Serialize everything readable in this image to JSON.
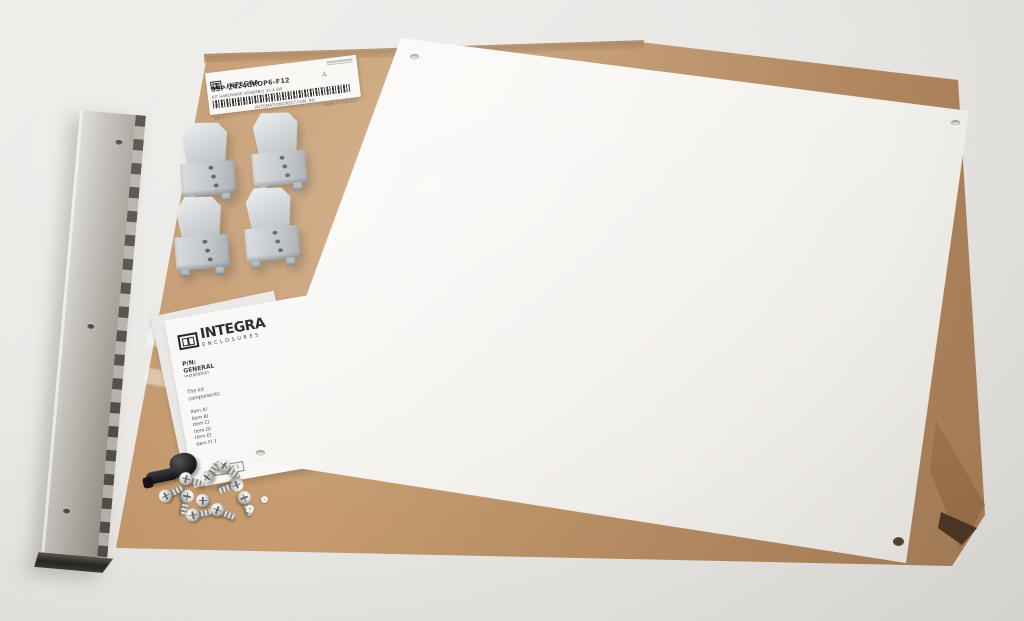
{
  "colors": {
    "background": "#e9e7e4",
    "cardboard": "#b98e63",
    "panel_white": "#f9f7f4",
    "hinge_metal": "#b0aca5",
    "clip_gray": "#c3c8cb"
  },
  "shipping_label": {
    "brand": "INTEGRA",
    "part_number": "SSP-2424GROP6-F12",
    "sub_line": "KIT HARDWARE ASSEMBLY 23-4 SW",
    "footer": "AUTOMATIONDIRECT.COM, INC",
    "lbl_note": "LBL 1",
    "origin": "MADE IN THE USA",
    "warning_glyph": "⚠"
  },
  "instruction_sheet": {
    "brand": "INTEGRA",
    "brand_sub": "ENCLOSURES",
    "pn_label": "P/N:",
    "pn_value": "GENERAL",
    "subtitle": "Installation",
    "intro_line1": "The kit",
    "intro_line2": "components:",
    "items": [
      "Item A)",
      "Item B)",
      "Item C)",
      "Item D)",
      "Item E)",
      "Item F) 1"
    ],
    "figure_label": "FIGURE 1"
  }
}
